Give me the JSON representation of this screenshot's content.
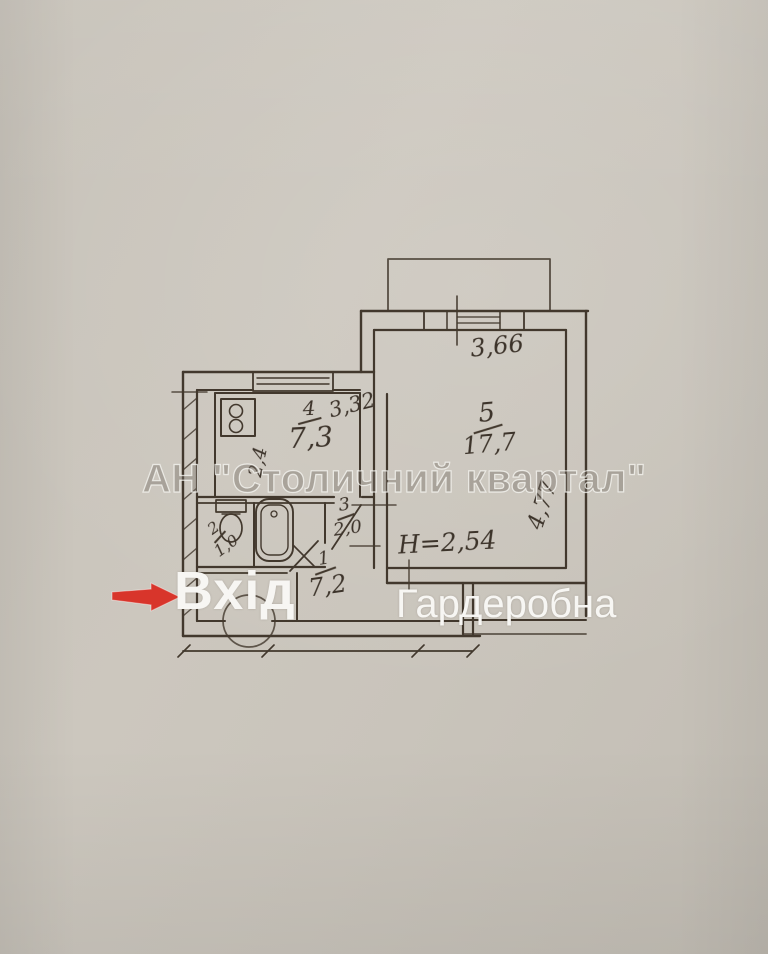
{
  "overlay": {
    "watermark": "АН \"Столичний квартал\"",
    "entrance_label": "Вхід",
    "wardrobe_label": "Гардеробна",
    "arrow_icon": "red-entrance-arrow",
    "arrow_color": "#d8352b",
    "label_color": "#f7f6f3"
  },
  "plan": {
    "ceiling_height": "H=2,54",
    "rooms": [
      {
        "number": "1",
        "area": "7,2",
        "name": "hallway"
      },
      {
        "number": "2",
        "area": "1,0",
        "name": "toilet"
      },
      {
        "number": "3",
        "area": "2,0",
        "name": "bathroom"
      },
      {
        "number": "4",
        "area": "7,3",
        "name": "kitchen"
      },
      {
        "number": "5",
        "area": "17,7",
        "name": "living-room"
      }
    ],
    "dims": {
      "room5_width": "3,66",
      "room5_depth": "4,77",
      "kitchen_width": "3,32",
      "kitchen_depth": "2,4"
    },
    "ink_color": "#42382d",
    "paper_color": "#c9c4bb"
  }
}
